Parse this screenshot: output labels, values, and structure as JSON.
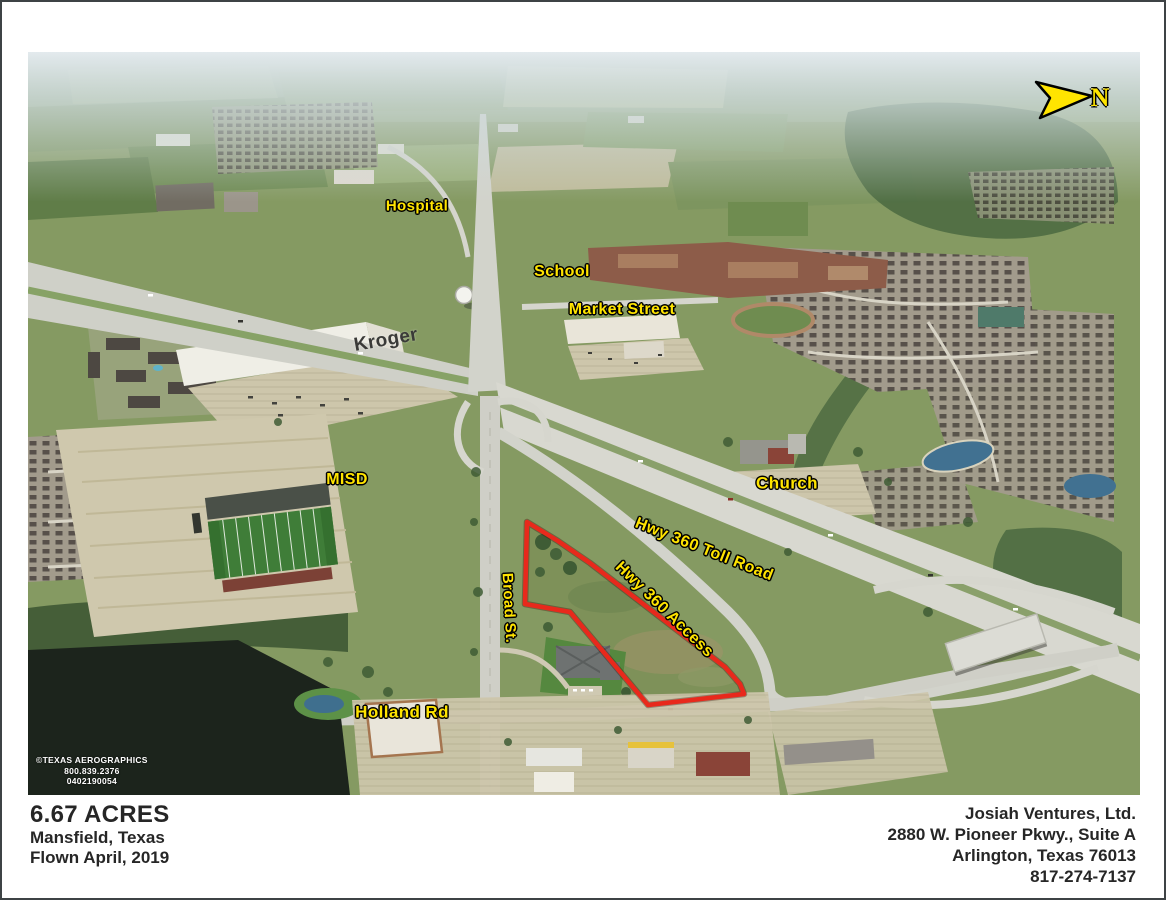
{
  "page": {
    "left": {
      "acreage": "6.67 ACRES",
      "location": "Mansfield, Texas",
      "flown": "Flown April, 2019"
    },
    "right": {
      "company": "Josiah Ventures, Ltd.",
      "address": "2880 W. Pioneer Pkwy., Suite A",
      "city": "Arlington, Texas 76013",
      "phone": "817-274-7137"
    }
  },
  "photo": {
    "north": "N",
    "credit": {
      "name": "©TEXAS AEROGRAPHICS",
      "phone": "800.839.2376",
      "job": "0402190054"
    },
    "labels": {
      "hospital": "Hospital",
      "school": "School",
      "market_street": "Market Street",
      "kroger": "Kroger",
      "misd": "MISD",
      "church": "Church",
      "hwy_toll": "Hwy 360 Toll Road",
      "hwy_access": "Hwy 360 Access",
      "broad_st": "Broad St.",
      "holland_rd": "Holland Rd"
    },
    "colors": {
      "label_yellow": "#ffe400",
      "boundary_red": "#e8291c"
    }
  }
}
